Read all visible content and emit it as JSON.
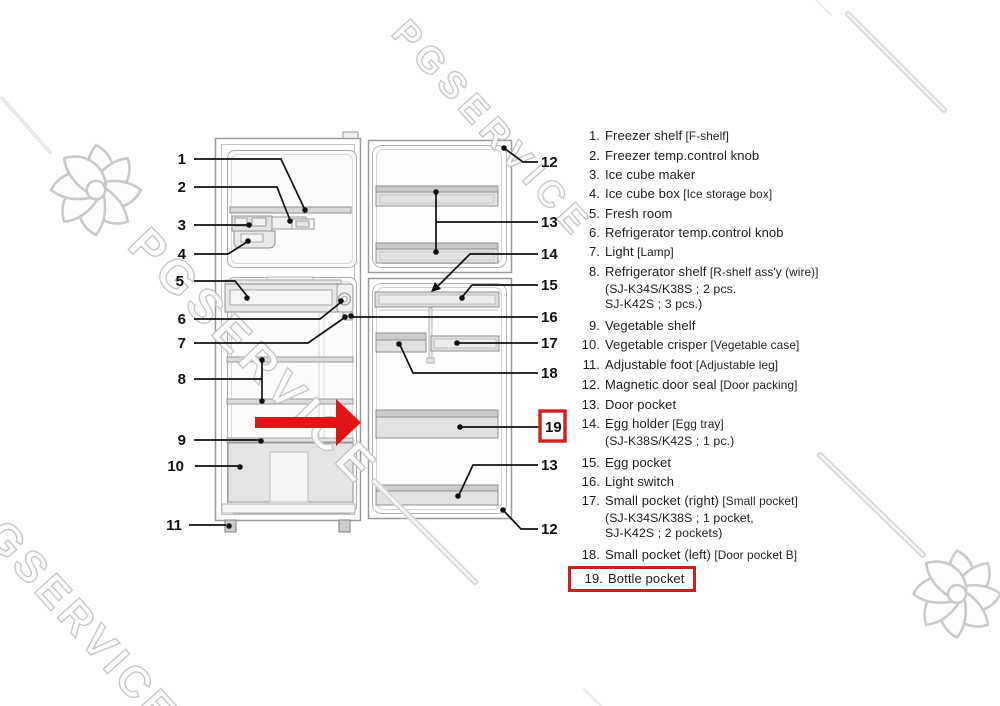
{
  "watermark": {
    "text": "PGSERVICE",
    "flower_icon": "pgservice-flower",
    "color": "#c7c7c7"
  },
  "annotation": {
    "arrow_color": "#e31414",
    "highlight_box_color": "#cf1f1f",
    "highlighted_item": "19"
  },
  "diagram": {
    "callouts": [
      {
        "n": "1",
        "side": "left",
        "x": 186,
        "y": 164
      },
      {
        "n": "2",
        "side": "left",
        "x": 186,
        "y": 192
      },
      {
        "n": "3",
        "side": "left",
        "x": 186,
        "y": 230
      },
      {
        "n": "4",
        "side": "left",
        "x": 186,
        "y": 259
      },
      {
        "n": "5",
        "side": "left",
        "x": 184,
        "y": 286
      },
      {
        "n": "6",
        "side": "left",
        "x": 186,
        "y": 324
      },
      {
        "n": "7",
        "side": "left",
        "x": 186,
        "y": 348
      },
      {
        "n": "8",
        "side": "left",
        "x": 186,
        "y": 384
      },
      {
        "n": "9",
        "side": "left",
        "x": 186,
        "y": 445
      },
      {
        "n": "10",
        "side": "left",
        "x": 184,
        "y": 471
      },
      {
        "n": "11",
        "side": "left",
        "x": 182,
        "y": 530
      },
      {
        "n": "12",
        "side": "right",
        "x": 541,
        "y": 167
      },
      {
        "n": "13",
        "side": "right",
        "x": 541,
        "y": 227
      },
      {
        "n": "14",
        "side": "right",
        "x": 541,
        "y": 259
      },
      {
        "n": "15",
        "side": "right",
        "x": 541,
        "y": 290
      },
      {
        "n": "16",
        "side": "right",
        "x": 541,
        "y": 322
      },
      {
        "n": "17",
        "side": "right",
        "x": 541,
        "y": 348
      },
      {
        "n": "18",
        "side": "right",
        "x": 541,
        "y": 378
      },
      {
        "n": "19",
        "side": "right",
        "x": 545,
        "y": 432,
        "boxed": true
      },
      {
        "n": "13",
        "side": "right",
        "x": 541,
        "y": 470
      },
      {
        "n": "12",
        "side": "right",
        "x": 541,
        "y": 534
      }
    ]
  },
  "parts_list": {
    "items": [
      {
        "num": "1.",
        "text": "Freezer shelf",
        "note": "[F-shelf]"
      },
      {
        "num": "2.",
        "text": "Freezer temp.control knob"
      },
      {
        "num": "3.",
        "text": "Ice cube maker"
      },
      {
        "num": "4.",
        "text": "Ice cube box",
        "note": "[Ice storage box]"
      },
      {
        "num": "5.",
        "text": "Fresh room"
      },
      {
        "num": "6.",
        "text": "Refrigerator temp.control knob"
      },
      {
        "num": "7.",
        "text": "Light",
        "note": "[Lamp]"
      },
      {
        "num": "8.",
        "text": "Refrigerator shelf",
        "note": "[R-shelf ass'y (wire)]",
        "subs": [
          "(SJ-K34S/K38S ; 2 pcs.",
          "SJ-K42S ; 3 pcs.)"
        ]
      },
      {
        "num": "9.",
        "text": "Vegetable shelf"
      },
      {
        "num": "10.",
        "text": "Vegetable crisper",
        "note": "[Vegetable case]"
      },
      {
        "num": "11.",
        "text": "Adjustable foot",
        "note": "[Adjustable leg]"
      },
      {
        "num": "12.",
        "text": "Magnetic door seal",
        "note": "[Door packing]"
      },
      {
        "num": "13.",
        "text": "Door pocket"
      },
      {
        "num": "14.",
        "text": "Egg holder",
        "note": "[Egg tray]",
        "subs": [
          "(SJ-K38S/K42S ; 1 pc.)"
        ]
      },
      {
        "num": "15.",
        "text": "Egg pocket"
      },
      {
        "num": "16.",
        "text": "Light switch"
      },
      {
        "num": "17.",
        "text": "Small pocket (right)",
        "note": "[Small pocket]",
        "subs": [
          "(SJ-K34S/K38S ; 1 pocket,",
          "SJ-K42S ; 2 pockets)"
        ]
      },
      {
        "num": "18.",
        "text": "Small pocket (left)",
        "note": "[Door pocket B]"
      },
      {
        "num": "19.",
        "text": "Bottle pocket",
        "boxed": true
      }
    ]
  }
}
